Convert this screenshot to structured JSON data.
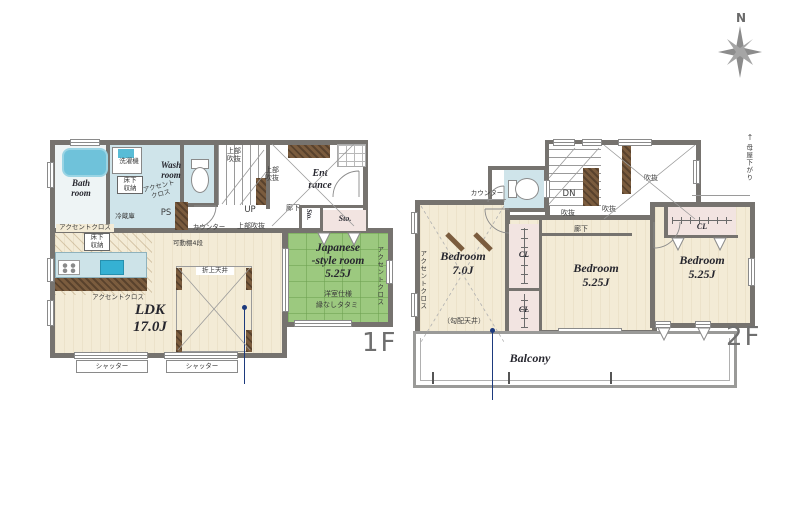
{
  "compass": {
    "north_label": "N"
  },
  "floor1": {
    "floor_label": "1F",
    "bath_room": "Bath\nroom",
    "wash_room": "Wash\nroom",
    "washer": "洗濯機",
    "underfloor_storage_wash": "床下\n収納",
    "underfloor_storage_kitchen": "床下\n収納",
    "accent_cloth_wash": "アクセント\nクロス",
    "accent_cloth_kitchen_top": "アクセントクロス",
    "accent_cloth_kitchen_bottom": "アクセントクロス",
    "accent_cloth_tatami": "アクセントクロス",
    "pipe_space": "PS",
    "fridge": "冷蔵庫",
    "movable_shelf": "可動棚4段",
    "counter": "カウンター",
    "void_upper_1": "上部\n吹抜",
    "void_upper_2": "上部\n吹抜",
    "void_upper_3": "上部吹抜",
    "stairs_up": "UP",
    "hallway": "廊下",
    "entrance": "Ent\nrance",
    "storage_small": "Sto.",
    "storage_large": "Sto.",
    "ldk": "LDK\n17.0J",
    "coffered_ceiling": "折上天井",
    "japanese_room": "Japanese\n-style room\n5.25J",
    "japanese_room_note1": "洋室仕様",
    "japanese_room_note2": "縁なしタタミ",
    "shutter_left": "シャッター",
    "shutter_right": "シャッター"
  },
  "floor2": {
    "floor_label": "2F",
    "counter": "カウンター",
    "stairs_down": "DN",
    "void_1": "吹抜",
    "void_2": "吹抜",
    "void_3": "吹抜",
    "hallway": "廊下",
    "main_roof_lowered": "母屋下がり",
    "main_roof_arrow": "↑",
    "bedroom_1": "Bedroom\n7.0J",
    "bedroom_1_note": "（勾配天井）",
    "bedroom_2": "Bedroom\n5.25J",
    "bedroom_3": "Bedroom\n5.25J",
    "closet_1": "CL",
    "closet_2": "CL",
    "closet_3": "CL",
    "accent_cloth": "アクセントクロス",
    "balcony": "Balcony"
  },
  "colors": {
    "wall": "#76736f",
    "floor_wood": "#f3ebd6",
    "wet_area": "#cfe4ea",
    "tub": "#6fc2da",
    "tatami_green": "#9cc97f",
    "storage_pink": "#f2e4e1",
    "cabinet_brown": "#7b5c3e",
    "sink_blue": "#35b1d3",
    "label_dark": "#26262e",
    "floor_label_gray": "#6f6f6f",
    "marker_navy": "#1d3a7d"
  }
}
